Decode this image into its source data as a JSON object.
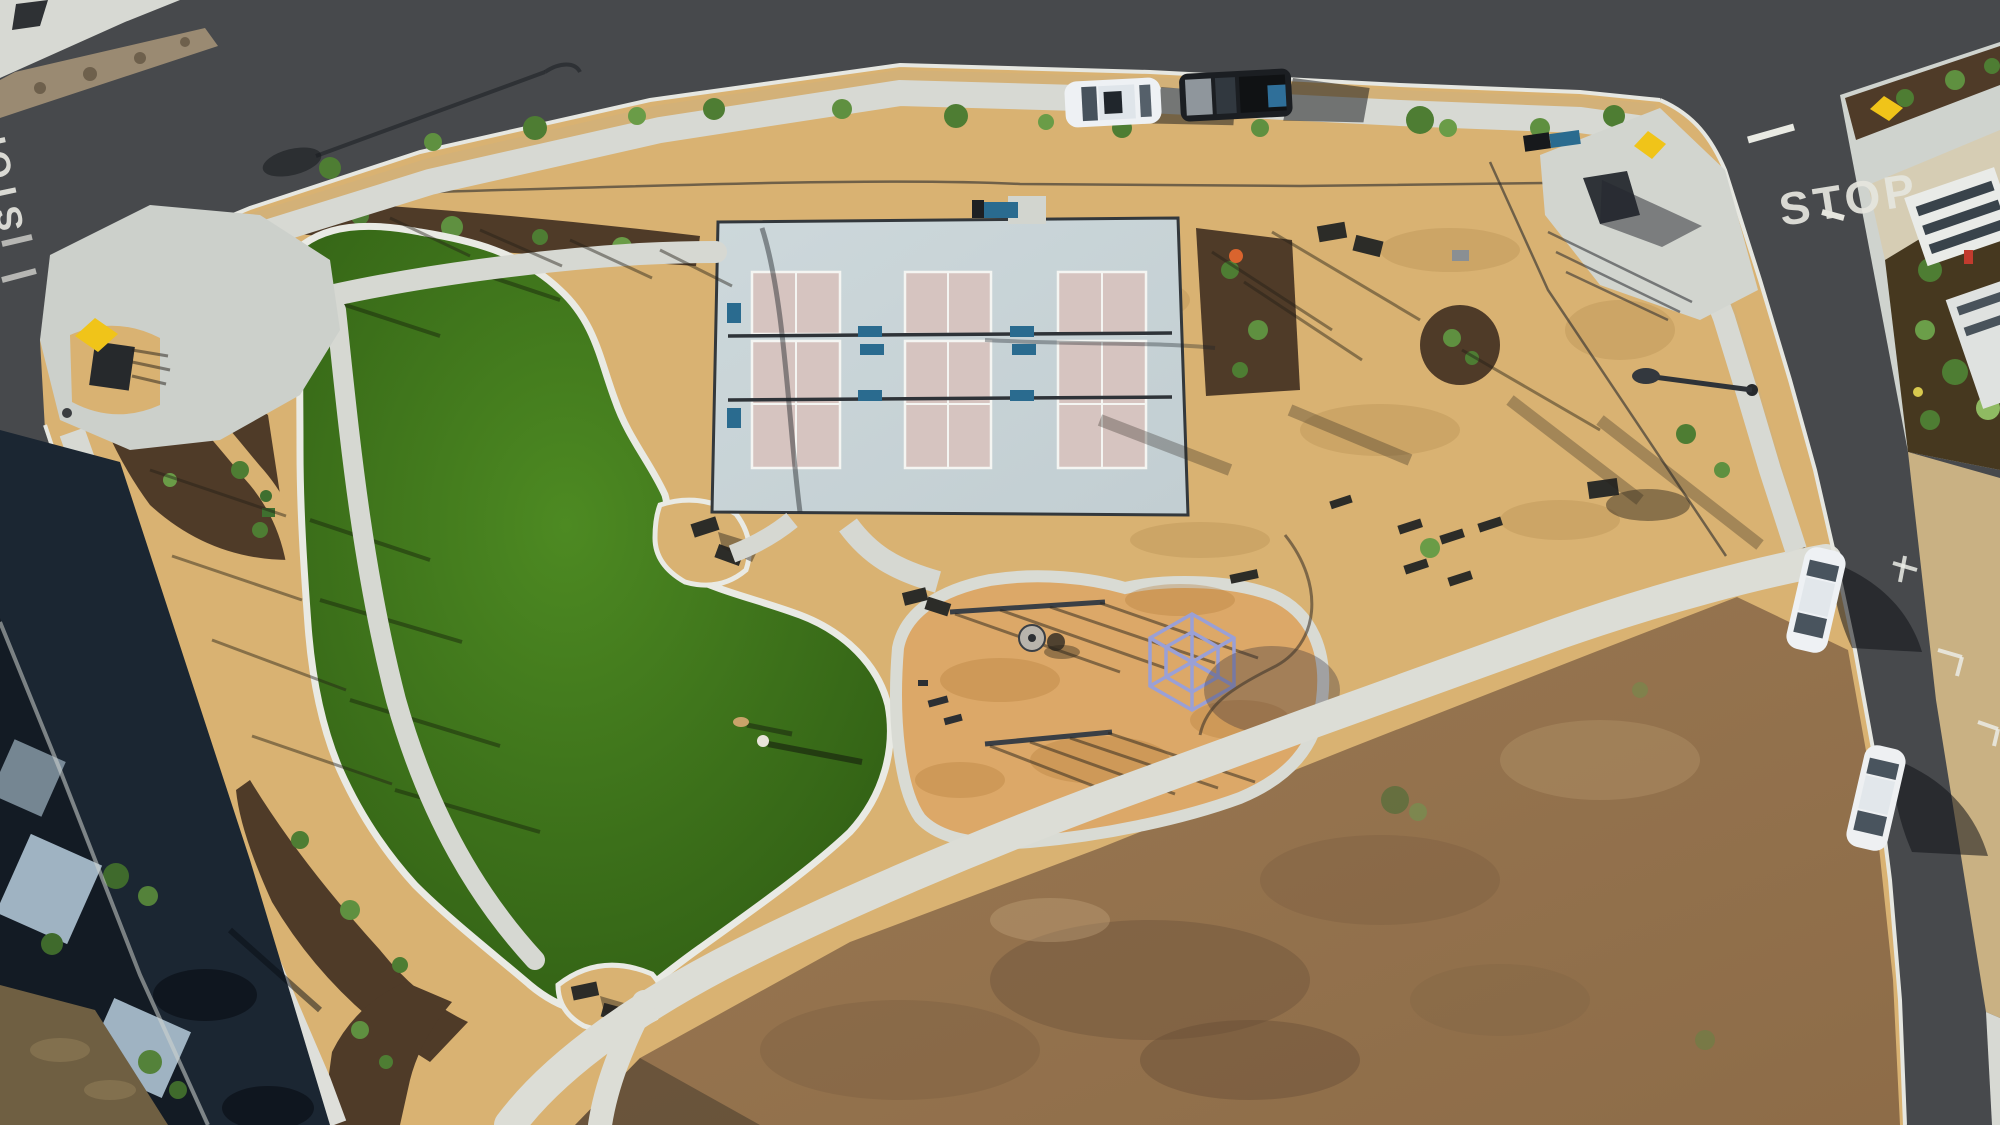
{
  "scene": {
    "description": "Aerial drone view of a new neighborhood pocket park with pickleball courts, kidney-shaped lawn, playground and surrounding streets, photographed late afternoon with long shadows"
  },
  "road_markings": {
    "stop_west": "STOP",
    "stop_northeast": "STOP"
  },
  "inventory": {
    "pickleball_courts": 3,
    "parked_cars_top_street": 2,
    "parked_cars_right_street": 2,
    "people_on_lawn": 1,
    "dogs_on_lawn": 1,
    "picnic_tables": 8,
    "swing_sets": 2,
    "climbing_dome": 1
  },
  "colors": {
    "asphalt": "#47494c",
    "asphalt_shadow": "#1b2632",
    "concrete": "#d7d9d3",
    "concrete_shaded": "#9fb0c0",
    "curb_white": "#e6e7e1",
    "dg_tan": "#d9b272",
    "ewf_playground": "#dca868",
    "mulch": "#4f3b28",
    "lawn_green": "#3f7a1c",
    "mow_band": "#e9eae4",
    "dirt_lot": "#97754f",
    "court_pad": "#c9d4d8",
    "court_surface": "#d6c4c0",
    "court_line": "#f4f5f2",
    "net_dark": "#2e3338",
    "bench_blue": "#2a6b8f",
    "dome_purple": "#9aa0d6",
    "car_white": "#eef1f4",
    "car_black": "#1b1e22",
    "truck_cargo_blue": "#2f6f99",
    "ramp_pad_yellow": "#f0c419",
    "building_roof": "#e9ebe8",
    "shrub_green": "#4e7d33",
    "flower_orange": "#d9642e"
  }
}
